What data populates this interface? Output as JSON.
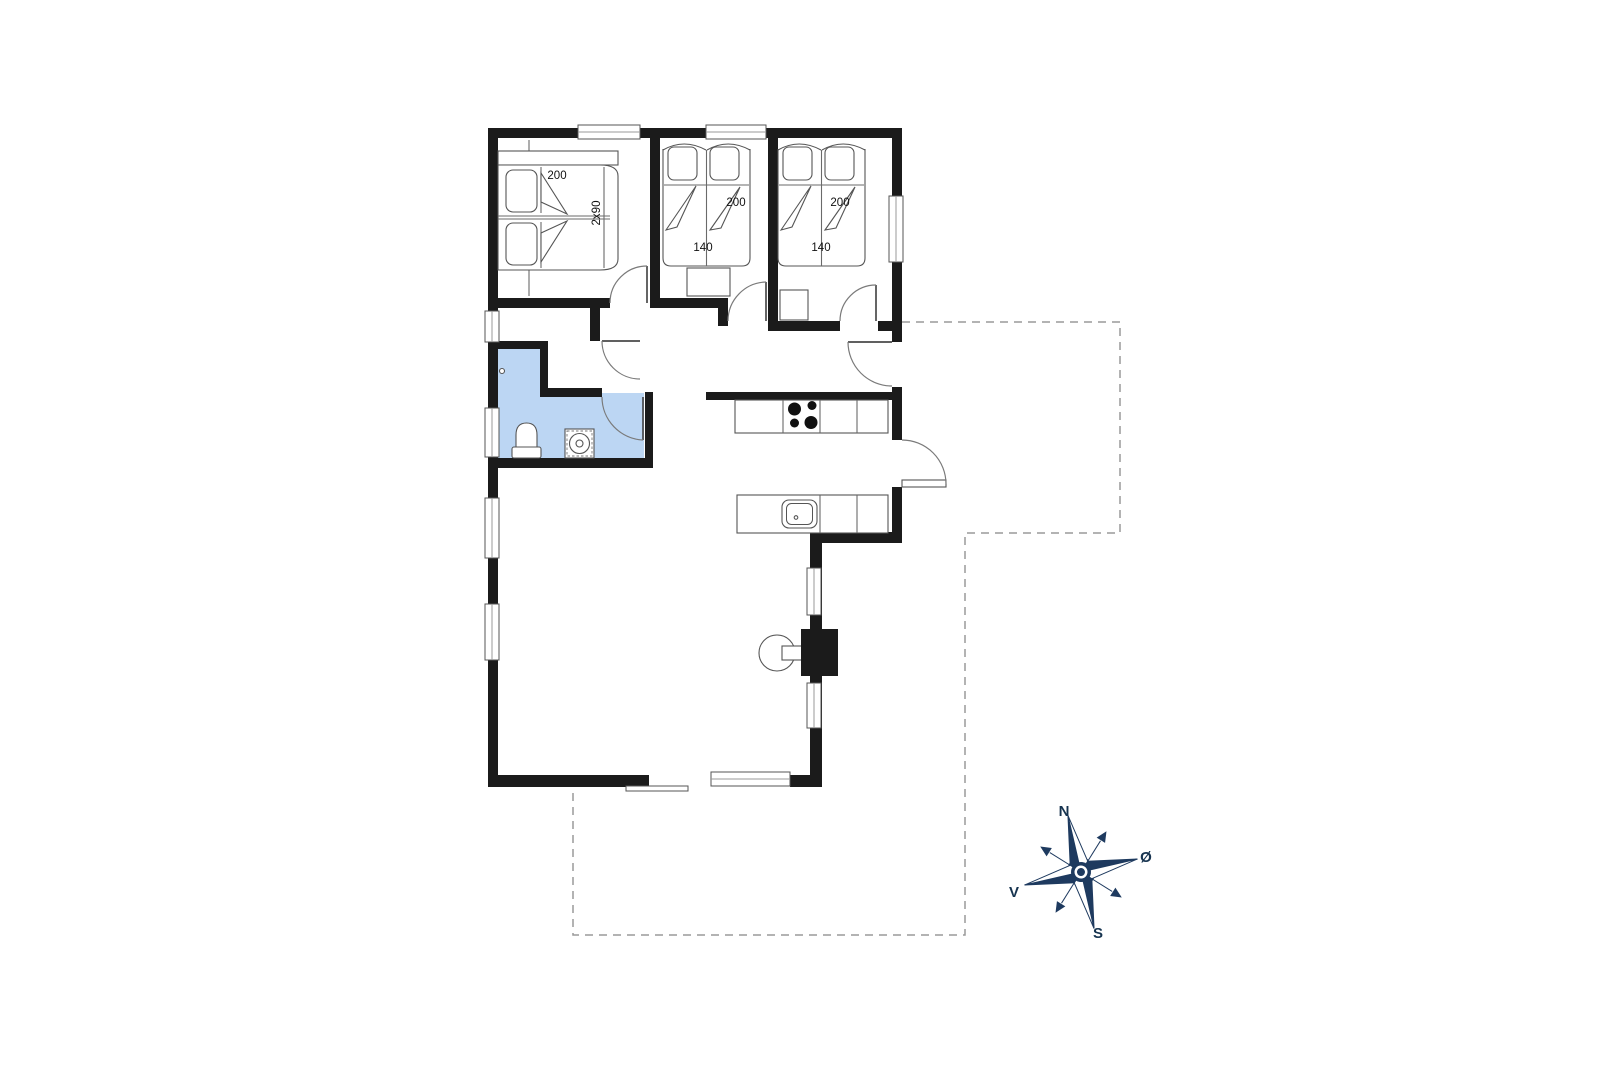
{
  "floorplan": {
    "bedroom1": {
      "bed_length_label": "200",
      "bed_width_label": "2x90"
    },
    "bedroom2": {
      "bed_length_label": "200",
      "bed_width_label": "140"
    },
    "bedroom3": {
      "bed_length_label": "200",
      "bed_width_label": "140"
    },
    "compass": {
      "north_label": "N",
      "east_label": "Ø",
      "south_label": "S",
      "west_label": "V"
    },
    "colors": {
      "background": "#ffffff",
      "wall": "#1b1b1b",
      "bathroom_fill": "#bcd6f3",
      "compass_navy": "#1e3a5f",
      "furniture_line": "#6a6a6a",
      "terrace_dash": "#9a9a9a"
    }
  }
}
